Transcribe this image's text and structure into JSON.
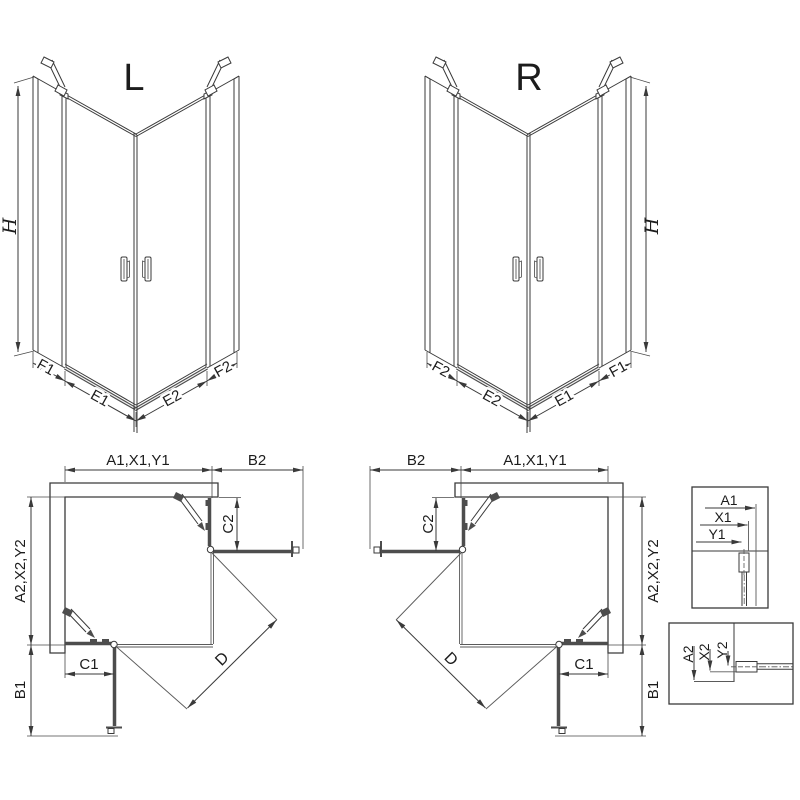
{
  "drawing": {
    "iso_left": {
      "variant": "L",
      "height": "H",
      "f1": "F1",
      "e1": "E1",
      "e2": "E2",
      "f2": "F2"
    },
    "iso_right": {
      "variant": "R",
      "height": "H",
      "f1": "F1",
      "e1": "E1",
      "e2": "E2",
      "f2": "F2"
    },
    "plan_left": {
      "width_top": "A1,X1,Y1",
      "ext_top": "B2",
      "panel_top": "C2",
      "depth_side": "A2,X2,Y2",
      "panel_bottom": "C1",
      "ext_bottom": "B1",
      "diagonal": "D"
    },
    "plan_right": {
      "width_top": "A1,X1,Y1",
      "ext_top": "B2",
      "panel_top": "C2",
      "depth_side": "A2,X2,Y2",
      "panel_bottom": "C1",
      "ext_bottom": "B1",
      "diagonal": "D"
    },
    "detail_top": {
      "a": "A1",
      "x": "X1",
      "y": "Y1"
    },
    "detail_bottom": {
      "a": "A2",
      "x": "X2",
      "y": "Y2"
    }
  },
  "colors": {
    "background": "#ffffff",
    "line": "#3a3a3a",
    "profile": "#4d4d4d",
    "text": "#1c1c1c"
  }
}
